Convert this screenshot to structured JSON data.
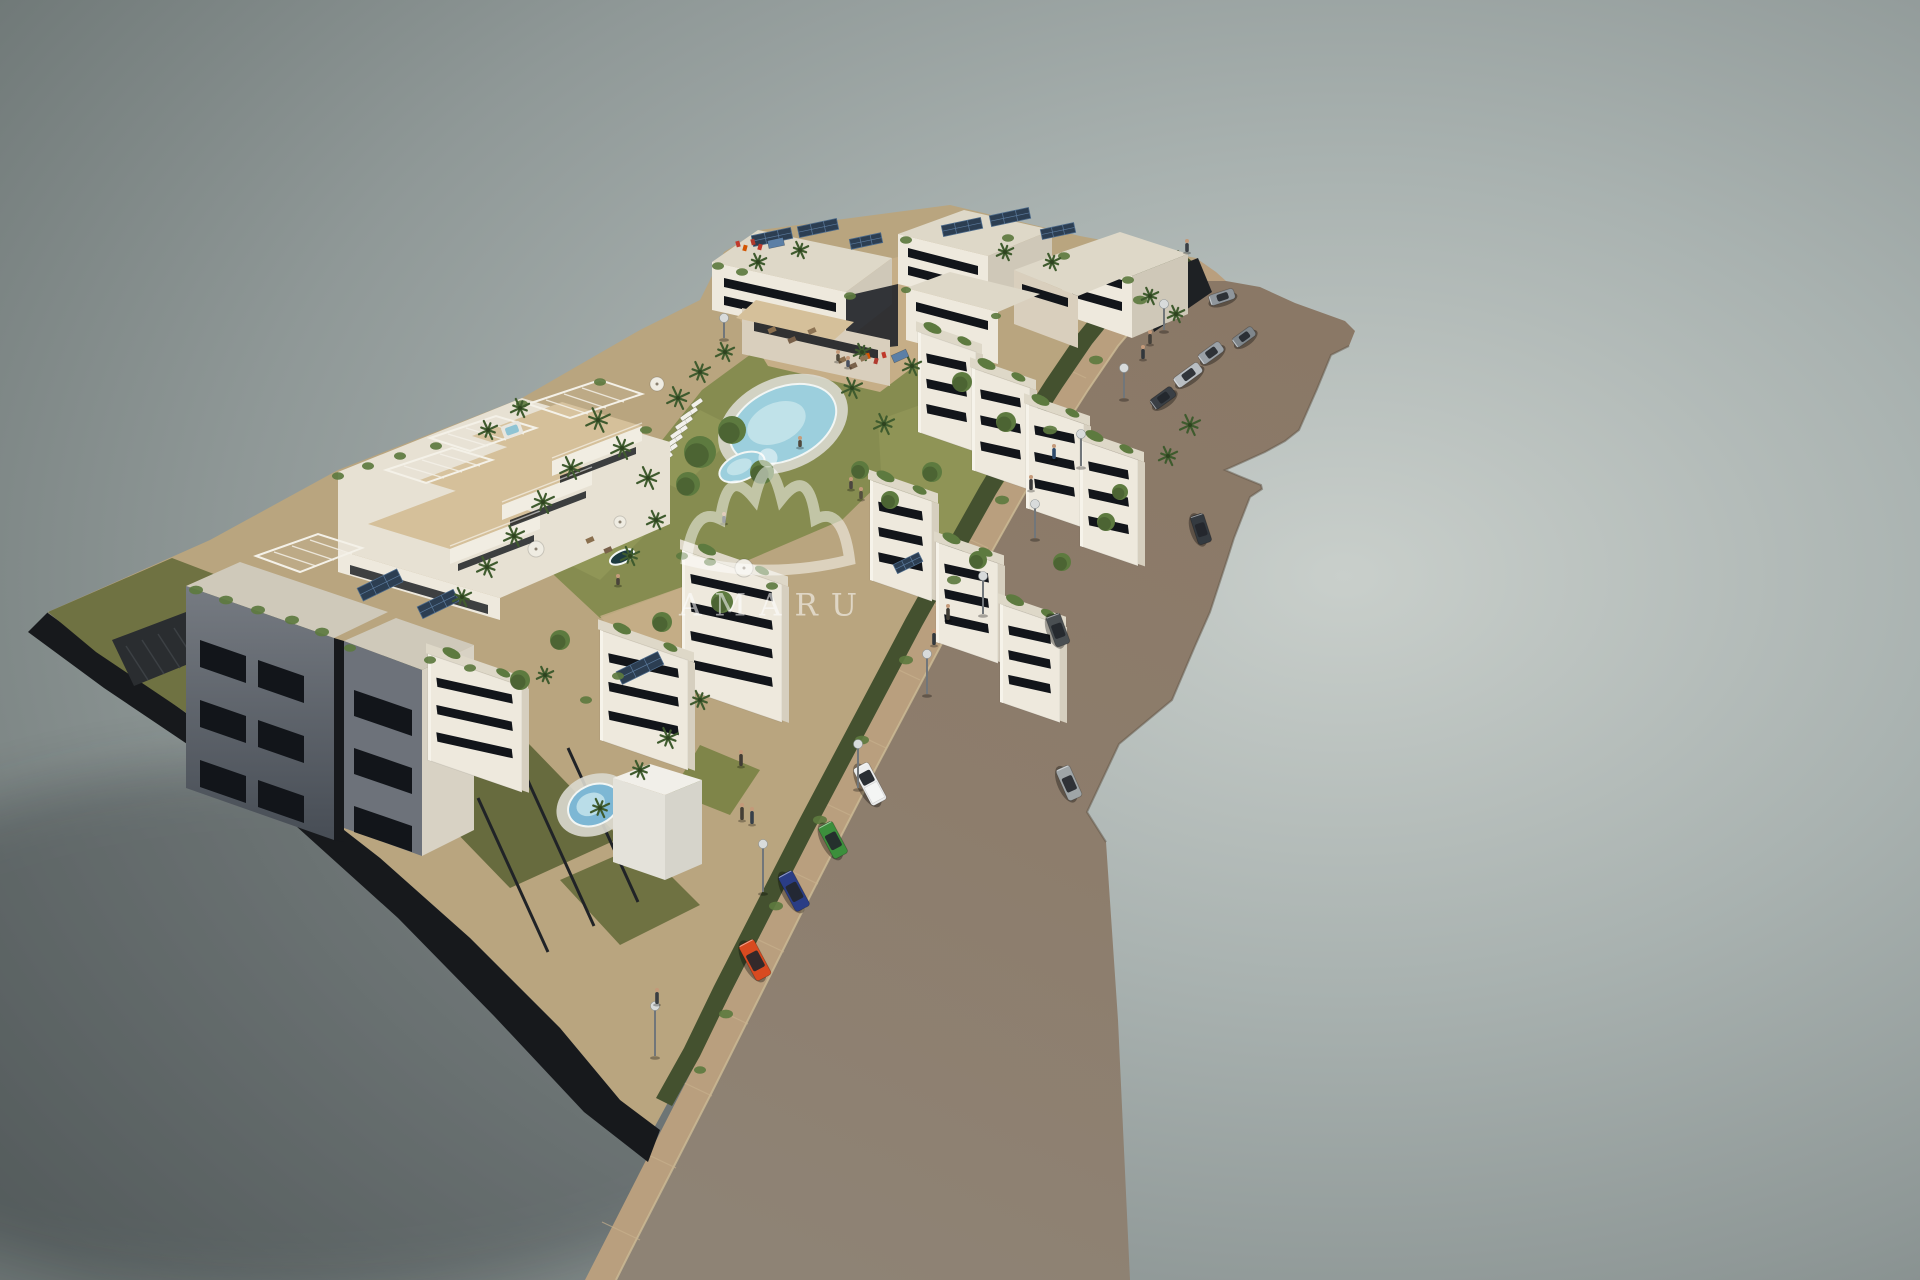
{
  "meta": {
    "subject": "aerial 3d architectural rendering of a residential apartment complex with gardens, pools, a road with cars and a gray studio backdrop"
  },
  "watermark": {
    "text": "AMARU",
    "logo": "crown-icon"
  },
  "palette": {
    "bg_light": "#c9cfcb",
    "bg_mid": "#a9b2b0",
    "bg_gray": "#8f9897",
    "bg_dark": "#6e7776",
    "road": "#8a7866",
    "road_mid": "#8d7d6c",
    "road_low": "#8e8375",
    "road_edge": "#5f5346",
    "sidewalk": "#b99f7e",
    "curb": "#cdbb96",
    "tick": "#c9b28e",
    "plot_base": "#b9a57f",
    "sand": "#c6ae87",
    "grass_olive": "#6f7242",
    "grass_green": "#868c50",
    "grass_bright": "#9aa05e",
    "hedge": "#44512f",
    "tree_green": "#5d7a3f",
    "palm_green": "#3f5b2e",
    "wall_white": "#eee9dd",
    "wall_cream": "#d9cfbd",
    "wall_shade": "#cfc8b8",
    "wall_dark": "#5d636c",
    "facade_shadow": "#454b54",
    "opening": "#12151a",
    "deck": "#c2a379",
    "deck_light": "#d5c09a",
    "solar": "#2c3e52",
    "pool_blue": "#9ccfdd",
    "pool_light": "#c9e6ec",
    "pool_front": "#7db7d4",
    "pool_dark": "#1d3a40",
    "plinth": "#17191c",
    "lamp_gray": "#d8dbdb",
    "watermark": "rgba(255,255,255,0.55)"
  },
  "scene": {
    "cars": [
      {
        "name": "parked-silver-car-top",
        "x": 1222,
        "y": 297,
        "angle": -18,
        "len": 26,
        "wid": 11,
        "color": "#8f969c",
        "kind": "sedan"
      },
      {
        "name": "driving-gray-car",
        "x": 1244,
        "y": 337,
        "angle": -36,
        "len": 24,
        "wid": 11,
        "color": "#7f868b",
        "kind": "sedan"
      },
      {
        "name": "parked-gray-hatch",
        "x": 1211,
        "y": 353,
        "angle": -36,
        "len": 26,
        "wid": 12,
        "color": "#9aa1a7",
        "kind": "hatch"
      },
      {
        "name": "parked-silver-sedan",
        "x": 1188,
        "y": 375,
        "angle": -36,
        "len": 30,
        "wid": 12,
        "color": "#b9bec2",
        "kind": "sedan"
      },
      {
        "name": "parked-dark-sedan",
        "x": 1163,
        "y": 398,
        "angle": -36,
        "len": 26,
        "wid": 12,
        "color": "#3a3f45",
        "kind": "sedan"
      },
      {
        "name": "driving-dark-suv",
        "x": 1201,
        "y": 529,
        "angle": 72,
        "len": 30,
        "wid": 14,
        "color": "#343a40",
        "kind": "suv"
      },
      {
        "name": "driving-gray-suv",
        "x": 1058,
        "y": 630,
        "angle": 70,
        "len": 32,
        "wid": 15,
        "color": "#4a4f52",
        "kind": "suv"
      },
      {
        "name": "driving-silver-suv",
        "x": 1069,
        "y": 783,
        "angle": 66,
        "len": 34,
        "wid": 15,
        "color": "#9fa5a7",
        "kind": "suv"
      },
      {
        "name": "parked-white-pickup",
        "x": 870,
        "y": 784,
        "angle": 62,
        "len": 42,
        "wid": 17,
        "color": "#eceded",
        "kind": "pickup"
      },
      {
        "name": "parked-green-hatch",
        "x": 833,
        "y": 840,
        "angle": 62,
        "len": 36,
        "wid": 16,
        "color": "#3c8f3c",
        "kind": "hatch"
      },
      {
        "name": "parked-blue-sedan",
        "x": 794,
        "y": 891,
        "angle": 62,
        "len": 40,
        "wid": 16,
        "color": "#2a3d85",
        "kind": "sedan"
      },
      {
        "name": "parked-red-hatch",
        "x": 755,
        "y": 960,
        "angle": 62,
        "len": 40,
        "wid": 17,
        "color": "#d84a20",
        "kind": "hatch"
      }
    ],
    "lamps": {
      "columns": [
        "x",
        "y",
        "height"
      ],
      "points": [
        [
          1164,
          330,
          26
        ],
        [
          1124,
          398,
          30
        ],
        [
          1081,
          466,
          32
        ],
        [
          1035,
          538,
          34
        ],
        [
          983,
          614,
          38
        ],
        [
          927,
          694,
          40
        ],
        [
          858,
          788,
          44
        ],
        [
          763,
          892,
          48
        ],
        [
          655,
          1056,
          50
        ],
        [
          724,
          338,
          20
        ]
      ]
    },
    "people": {
      "columns": [
        "x",
        "y",
        "height",
        "color"
      ],
      "points": [
        [
          1187,
          252,
          9,
          "#3a3f44"
        ],
        [
          1150,
          344,
          10,
          "#44403a"
        ],
        [
          1143,
          359,
          10,
          "#32373c"
        ],
        [
          1054,
          459,
          11,
          "#2e4a6b"
        ],
        [
          1031,
          490,
          11,
          "#3a3a3a"
        ],
        [
          948,
          620,
          12,
          "#403c34"
        ],
        [
          934,
          645,
          12,
          "#32383e"
        ],
        [
          742,
          820,
          13,
          "#453f36"
        ],
        [
          752,
          824,
          13,
          "#37404a"
        ],
        [
          741,
          766,
          12,
          "#413c34"
        ],
        [
          657,
          1004,
          12,
          "#3a3e42"
        ],
        [
          851,
          489,
          8,
          "#4c4640"
        ],
        [
          861,
          499,
          8,
          "#55503e"
        ],
        [
          838,
          361,
          7,
          "#514a3c"
        ],
        [
          848,
          367,
          7,
          "#4a5160"
        ],
        [
          800,
          447,
          7,
          "#50483c"
        ],
        [
          724,
          523,
          7,
          "#44494e"
        ],
        [
          618,
          585,
          7,
          "#4a443a"
        ]
      ]
    },
    "palms": {
      "columns": [
        "x",
        "y",
        "r"
      ],
      "points": [
        [
          598,
          420,
          13
        ],
        [
          622,
          448,
          12
        ],
        [
          648,
          478,
          12
        ],
        [
          571,
          468,
          12
        ],
        [
          543,
          502,
          12
        ],
        [
          514,
          536,
          11
        ],
        [
          487,
          567,
          11
        ],
        [
          462,
          597,
          10
        ],
        [
          678,
          398,
          12
        ],
        [
          700,
          372,
          11
        ],
        [
          725,
          352,
          10
        ],
        [
          852,
          388,
          11
        ],
        [
          884,
          424,
          11
        ],
        [
          912,
          366,
          10
        ],
        [
          862,
          352,
          9
        ],
        [
          656,
          520,
          10
        ],
        [
          630,
          556,
          10
        ],
        [
          1190,
          425,
          11
        ],
        [
          1168,
          456,
          10
        ],
        [
          758,
          262,
          9
        ],
        [
          800,
          250,
          9
        ],
        [
          1005,
          252,
          9
        ],
        [
          1052,
          262,
          9
        ],
        [
          1150,
          296,
          9
        ],
        [
          1176,
          314,
          9
        ],
        [
          668,
          738,
          11
        ],
        [
          640,
          770,
          10
        ],
        [
          600,
          808,
          10
        ],
        [
          700,
          700,
          10
        ],
        [
          545,
          675,
          9
        ],
        [
          488,
          430,
          10
        ],
        [
          520,
          408,
          10
        ]
      ]
    },
    "trees": {
      "columns": [
        "x",
        "y",
        "r"
      ],
      "points": [
        [
          700,
          452,
          16
        ],
        [
          732,
          430,
          14
        ],
        [
          762,
          472,
          12
        ],
        [
          688,
          484,
          12
        ],
        [
          962,
          382,
          10
        ],
        [
          1006,
          422,
          10
        ],
        [
          932,
          472,
          10
        ],
        [
          1106,
          522,
          9
        ],
        [
          1062,
          562,
          9
        ],
        [
          662,
          622,
          10
        ],
        [
          722,
          602,
          11
        ],
        [
          560,
          640,
          10
        ],
        [
          520,
          680,
          10
        ],
        [
          860,
          470,
          9
        ],
        [
          890,
          500,
          9
        ],
        [
          1120,
          492,
          8
        ],
        [
          978,
          560,
          9
        ]
      ]
    },
    "greenery": {
      "columns": [
        "x",
        "y",
        "r"
      ],
      "points": [
        [
          196,
          590,
          7
        ],
        [
          226,
          600,
          7
        ],
        [
          258,
          610,
          7
        ],
        [
          292,
          620,
          7
        ],
        [
          322,
          632,
          7
        ],
        [
          350,
          648,
          6
        ],
        [
          718,
          266,
          6
        ],
        [
          742,
          272,
          6
        ],
        [
          850,
          296,
          6
        ],
        [
          906,
          240,
          6
        ],
        [
          1008,
          238,
          6
        ],
        [
          1064,
          256,
          6
        ],
        [
          1128,
          280,
          6
        ],
        [
          906,
          290,
          5
        ],
        [
          996,
          316,
          5
        ],
        [
          682,
          556,
          6
        ],
        [
          710,
          562,
          6
        ],
        [
          772,
          586,
          6
        ],
        [
          430,
          660,
          6
        ],
        [
          470,
          668,
          6
        ],
        [
          522,
          404,
          6
        ],
        [
          600,
          382,
          6
        ],
        [
          646,
          430,
          6
        ],
        [
          338,
          476,
          6
        ],
        [
          368,
          466,
          6
        ],
        [
          400,
          456,
          6
        ],
        [
          436,
          446,
          6
        ],
        [
          1140,
          300,
          7
        ],
        [
          1096,
          360,
          7
        ],
        [
          1050,
          430,
          7
        ],
        [
          1002,
          500,
          7
        ],
        [
          954,
          580,
          7
        ],
        [
          906,
          660,
          7
        ],
        [
          862,
          740,
          7
        ],
        [
          820,
          820,
          7
        ],
        [
          776,
          906,
          7
        ],
        [
          726,
          1014,
          7
        ],
        [
          700,
          1070,
          6
        ],
        [
          586,
          700,
          6
        ],
        [
          618,
          676,
          6
        ]
      ]
    },
    "loungers": {
      "columns": [
        "x",
        "y"
      ],
      "angle": -35,
      "points": [
        [
          697,
          403
        ],
        [
          692,
          412
        ],
        [
          687,
          421
        ],
        [
          682,
          430
        ],
        [
          677,
          439
        ],
        [
          672,
          448
        ],
        [
          667,
          457
        ],
        [
          686,
          416
        ],
        [
          681,
          425
        ],
        [
          676,
          434
        ],
        [
          671,
          443
        ],
        [
          666,
          452
        ],
        [
          661,
          461
        ]
      ]
    },
    "solar_panels": {
      "columns": [
        "x",
        "y",
        "w",
        "h",
        "rot"
      ],
      "points": [
        [
          772,
          237,
          40,
          11,
          -12
        ],
        [
          818,
          228,
          40,
          11,
          -12
        ],
        [
          866,
          241,
          32,
          10,
          -12
        ],
        [
          962,
          227,
          40,
          11,
          -12
        ],
        [
          1010,
          217,
          40,
          11,
          -12
        ],
        [
          1058,
          231,
          34,
          10,
          -12
        ],
        [
          380,
          585,
          44,
          14,
          -26
        ],
        [
          438,
          604,
          40,
          13,
          -26
        ],
        [
          640,
          668,
          46,
          14,
          -26
        ],
        [
          908,
          563,
          28,
          10,
          -26
        ]
      ]
    },
    "white_blocks": {
      "columns": [
        "x",
        "y",
        "w",
        "h",
        "slits"
      ],
      "skew": 19,
      "points": [
        [
          918,
          332,
          58,
          100,
          3
        ],
        [
          972,
          368,
          58,
          102,
          3
        ],
        [
          1026,
          404,
          58,
          104,
          3
        ],
        [
          1080,
          440,
          58,
          106,
          3
        ],
        [
          870,
          480,
          62,
          100,
          3
        ],
        [
          936,
          542,
          62,
          100,
          3
        ],
        [
          1000,
          604,
          60,
          98,
          3
        ],
        [
          682,
          550,
          100,
          138,
          4
        ],
        [
          600,
          630,
          88,
          110,
          3
        ],
        [
          428,
          654,
          94,
          106,
          3
        ]
      ]
    },
    "pools": [
      {
        "cx": 783,
        "cy": 424,
        "rx": 56,
        "ry": 36,
        "rot": -24,
        "kind": "main"
      },
      {
        "cx": 742,
        "cy": 467,
        "rx": 24,
        "ry": 13,
        "rot": -24,
        "kind": "kids"
      },
      {
        "cx": 594,
        "cy": 805,
        "rx": 27,
        "ry": 20,
        "rot": -25,
        "kind": "front"
      },
      {
        "cx": 550,
        "cy": 567,
        "rx": 16,
        "ry": 7,
        "rot": -25,
        "kind": "private"
      },
      {
        "cx": 622,
        "cy": 557,
        "rx": 13,
        "ry": 6,
        "rot": -25,
        "kind": "private"
      }
    ],
    "umbrellas": {
      "columns": [
        "x",
        "y",
        "r"
      ],
      "points": [
        [
          657,
          384,
          7
        ],
        [
          536,
          549,
          8
        ],
        [
          744,
          568,
          9
        ],
        [
          620,
          522,
          6
        ]
      ]
    },
    "canopies": {
      "columns": [
        "x",
        "y",
        "w",
        "h",
        "rot"
      ],
      "color": "#5b7fa6",
      "points": [
        [
          776,
          243,
          16,
          8,
          -12
        ],
        [
          900,
          356,
          16,
          8,
          -24
        ]
      ]
    },
    "playground": {
      "columns": [
        "x",
        "y"
      ],
      "colors": [
        "#c0392b",
        "#d35400",
        "#b03a2e"
      ],
      "points": [
        [
          738,
          244
        ],
        [
          745,
          248
        ],
        [
          753,
          242
        ],
        [
          760,
          247
        ],
        [
          868,
          356
        ],
        [
          876,
          361
        ],
        [
          884,
          355
        ]
      ]
    },
    "furniture": {
      "columns": [
        "x",
        "y"
      ],
      "colors": [
        "#8a6f4e",
        "#79614a",
        "#8d7454"
      ],
      "points": [
        [
          842,
          360
        ],
        [
          853,
          366
        ],
        [
          864,
          358
        ],
        [
          772,
          330
        ],
        [
          792,
          340
        ],
        [
          812,
          331
        ],
        [
          590,
          540
        ],
        [
          608,
          550
        ]
      ]
    },
    "sidewalk_ticks": {
      "columns": [
        "x",
        "y"
      ],
      "points": [
        [
          640,
          1240
        ],
        [
          676,
          1168
        ],
        [
          712,
          1096
        ],
        [
          748,
          1024
        ],
        [
          784,
          952
        ],
        [
          818,
          884
        ],
        [
          852,
          816
        ],
        [
          886,
          748
        ],
        [
          920,
          680
        ],
        [
          954,
          614
        ],
        [
          988,
          548
        ],
        [
          1022,
          486
        ],
        [
          1054,
          430
        ],
        [
          1086,
          378
        ],
        [
          1118,
          330
        ],
        [
          1152,
          292
        ]
      ]
    }
  }
}
